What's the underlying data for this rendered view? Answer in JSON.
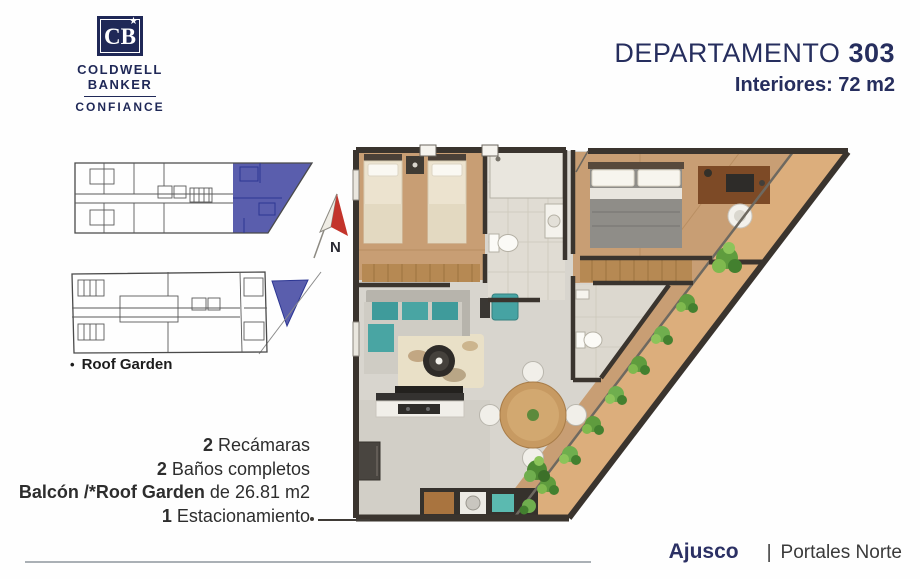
{
  "brand": {
    "monogram": "CB",
    "star": "★",
    "line1": "COLDWELL",
    "line2": "BANKER",
    "line3": "CONFIANCE"
  },
  "header": {
    "title": "DEPARTAMENTO ",
    "unit": "303",
    "subtitle": "Interiores: 72 m2"
  },
  "keyplans": {
    "roof_bullet": "•",
    "roof_label": "Roof Garden"
  },
  "compass": {
    "north": "N"
  },
  "details": {
    "lines": [
      {
        "strong": "2",
        "text": " Recámaras"
      },
      {
        "strong": "2",
        "text": " Baños completos"
      },
      {
        "strong": "Balcón /*Roof Garden",
        "text": " de 26.81 m2"
      },
      {
        "strong": "1",
        "text": " Estacionamiento"
      }
    ]
  },
  "footer": {
    "project": "Ajusco",
    "separator": "|",
    "area": "Portales Norte"
  },
  "colors": {
    "navy": "#262e5e",
    "highlight_blue": "#5a5ead",
    "wall_dark": "#3a342e",
    "wood_floor": "#c89e74",
    "balcony_wood": "#dcae7c",
    "plant_green": "#5f9c3e",
    "teal_accent": "#3f9b9b",
    "compass_red": "#c3342b"
  }
}
